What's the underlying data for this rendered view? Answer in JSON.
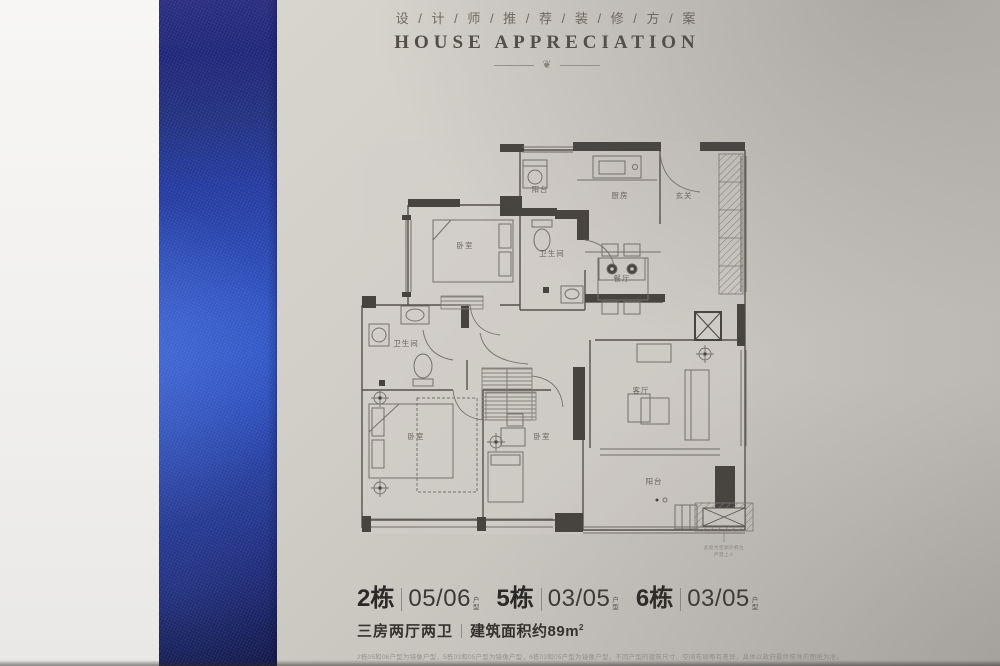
{
  "header": {
    "title_cn": "设 / 计 / 师 / 推 / 荐 / 装 / 修 / 方 / 案",
    "title_en": "HOUSE APPRECIATION",
    "ornament": "❦"
  },
  "floorplan": {
    "rooms": {
      "balcony_top": "阳台",
      "kitchen": "厨房",
      "entry": "玄关",
      "bedroom_a": "卧室",
      "bathroom_a": "卫生间",
      "dining": "餐厅",
      "bathroom_b": "卫生间",
      "living": "客厅",
      "bedroom_b": "卧室",
      "bedroom_c": "卧室",
      "balcony_bottom": "阳台"
    },
    "ac_note_1": "此处为空调外机位",
    "ac_note_2": "严禁上人"
  },
  "footer": {
    "units": [
      {
        "building": "2栋",
        "unit": "05/06",
        "suffix_chars": [
          "户",
          "型"
        ]
      },
      {
        "building": "5栋",
        "unit": "03/05",
        "suffix_chars": [
          "户",
          "型"
        ]
      },
      {
        "building": "6栋",
        "unit": "03/05",
        "suffix_chars": [
          "户",
          "型"
        ]
      }
    ],
    "spec": "三房两厅两卫",
    "area": "建筑面积约89m",
    "area_sup": "2",
    "disclaimer": "2栋05和06户型为镜像户型，5栋03和05户型为镜像户型，6栋03和05户型为镜像户型，不同户型的建筑尺寸、空间布局略有差异，具体以政府最终核准的图纸为准。"
  },
  "colors": {
    "accent_blue": "#2f54c2",
    "paper": "#c9c5bf",
    "wall_dark": "#474440"
  }
}
